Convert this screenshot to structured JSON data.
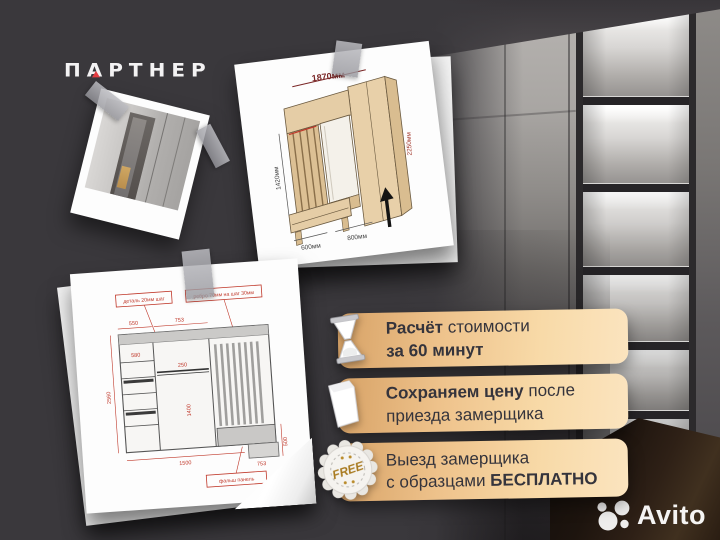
{
  "meta": {
    "background_color": "#3a383c",
    "accent_red": "#e23c41",
    "banner_text_color": "#35343c",
    "banner_gradient": [
      "#d7a266",
      "#fbe4bf"
    ],
    "free_gold": "#a87a1f",
    "icons": [
      "partner-logo",
      "hourglass-icon",
      "document-icon",
      "free-badge-icon",
      "avito-logo",
      "tape",
      "black-arrow"
    ]
  },
  "brand": {
    "name": "ПАРТНЕР",
    "letters": [
      "П",
      "А",
      "Р",
      "Т",
      "Н",
      "Е",
      "Р"
    ]
  },
  "offers": [
    {
      "icon": "hourglass-icon",
      "line1_bold": "Расчёт",
      "line1_regular": " стоимости",
      "line2_bold": "за 60 минут",
      "line2_regular": ""
    },
    {
      "icon": "document-icon",
      "line1_bold": "Сохраняем цену",
      "line1_regular": " после",
      "line2_bold": "",
      "line2_regular": "приезда замерщика"
    },
    {
      "icon": "free-badge-icon",
      "badge_text": "FREE",
      "line1_bold": "",
      "line1_regular": "Выезд замерщика",
      "line2_regular": "с образцами ",
      "line2_bold": "БЕСПЛАТНО"
    }
  ],
  "watermark": {
    "icon": "avito-logo",
    "text": "Avito"
  },
  "drawings": {
    "hallway_3d": {
      "dim_top": "1870мм",
      "dim_left": "1420мм",
      "dim_right": "2250мм",
      "dim_bottom_left": "600мм",
      "dim_bottom_right": "800мм"
    },
    "front_view": {
      "label_top_left": "деталь 20мм шаг",
      "label_top_right": "ребро 70мм на шаг 30мм",
      "label_bottom": "фальш панель",
      "dim_top_left": "550",
      "dim_top_mid": "753",
      "dim_left_outer": "2560",
      "dim_left_inner": "580",
      "dim_rod": "250",
      "dim_mid_height": "1400",
      "dim_right": "500",
      "dim_bottom": "1500",
      "dim_bottom_right": "753"
    }
  }
}
